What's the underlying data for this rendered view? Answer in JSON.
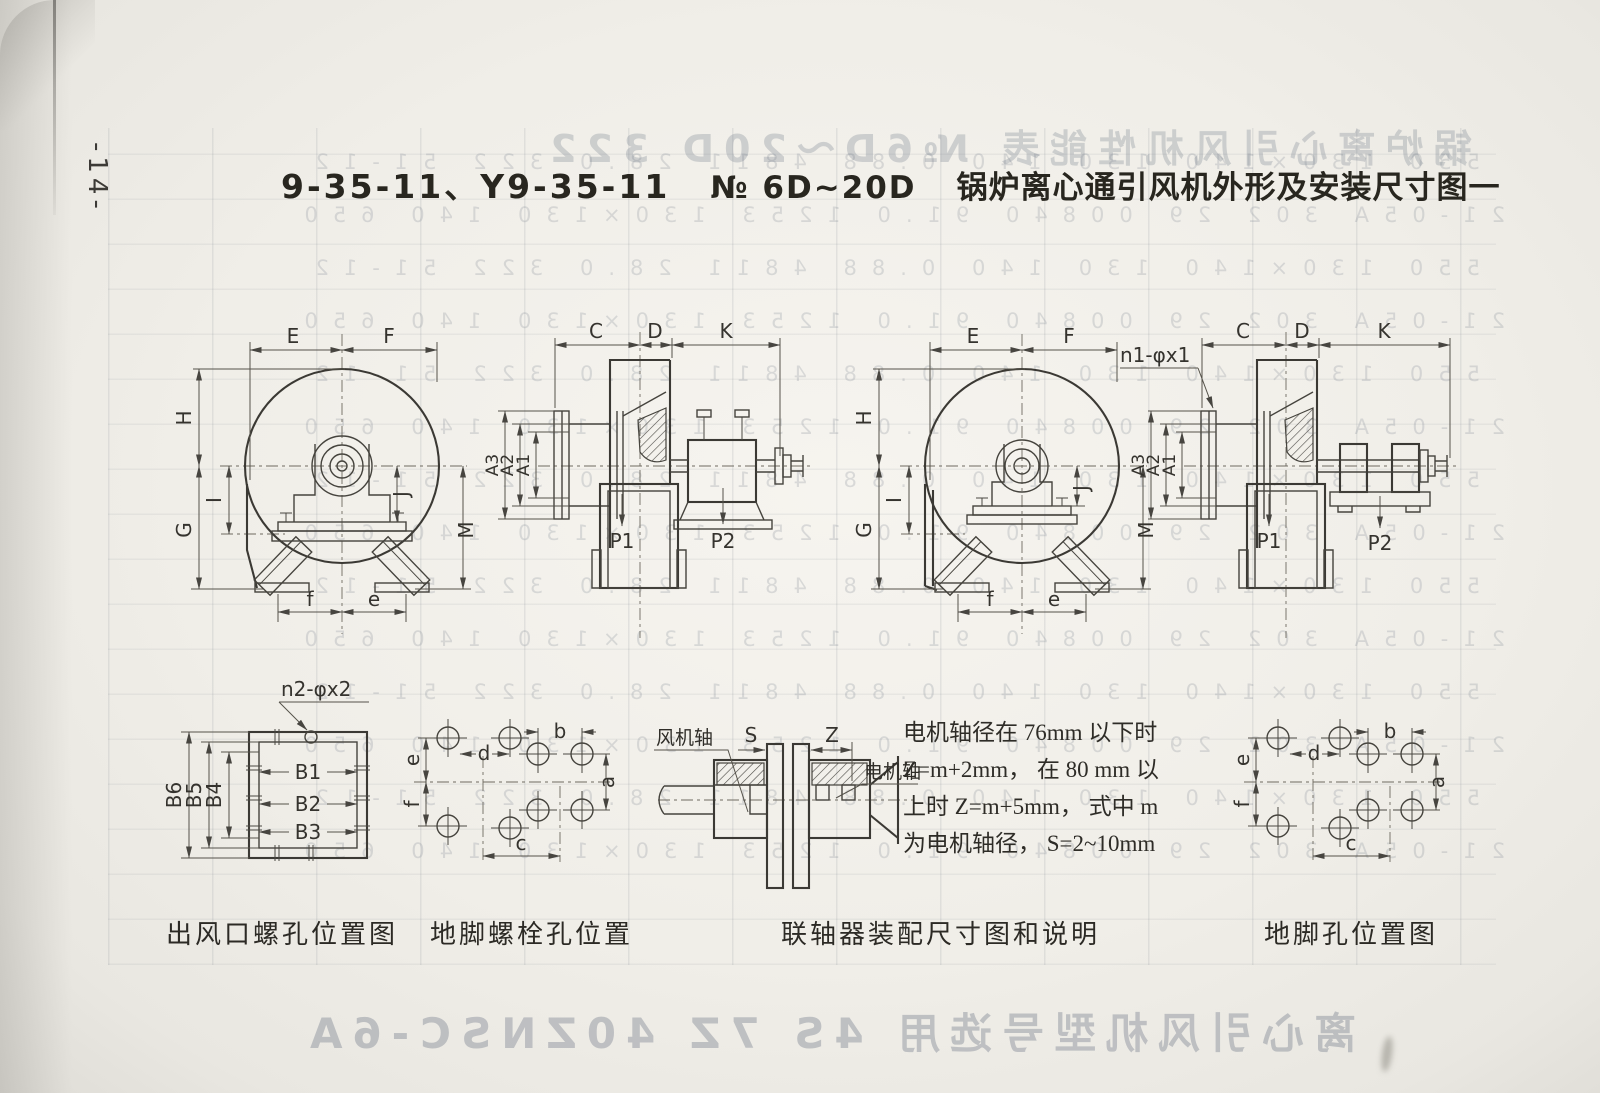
{
  "page": {
    "number": "-14-",
    "title": {
      "models": "9-35-11、Y9-35-11",
      "size_range": "№ 6D~20D",
      "name": "锅炉离心通引风机外形及安装尺寸图一"
    }
  },
  "labels": {
    "front": {
      "E": "E",
      "F": "F",
      "H": "H",
      "I": "I",
      "G": "G",
      "J": "J",
      "M": "M",
      "f": "f",
      "e": "e"
    },
    "side": {
      "C": "C",
      "D": "D",
      "K": "K",
      "A1": "A1",
      "A2": "A2",
      "A3": "A3",
      "P1": "P1",
      "P2": "P2",
      "n1": "n1-φx1"
    },
    "flange": {
      "note": "n2-φx2",
      "B1": "B1",
      "B2": "B2",
      "B3": "B3",
      "B4": "B4",
      "B5": "B5",
      "B6": "B6"
    },
    "foundation": {
      "a": "a",
      "b": "b",
      "c": "c",
      "d": "d",
      "e": "e",
      "f": "f"
    },
    "coupling": {
      "S": "S",
      "Z": "Z",
      "fan_shaft": "风机轴",
      "motor_shaft": "电机轴"
    }
  },
  "note": {
    "lines": [
      "电机轴径在 76mm 以下时",
      "Z=m+2mm， 在 80 mm 以",
      "上时 Z=m+5mm， 式中 m",
      "为电机轴径， S=2~10mm"
    ]
  },
  "captions": {
    "outlet_flange": "出风口螺孔位置图",
    "foundation_bolts": "地脚螺栓孔位置",
    "coupling": "联轴器装配尺寸图和说明",
    "foundation_holes": "地脚孔位置图"
  },
  "ghost": {
    "row_a": "550  130×140  130  140  0.88  4811  28.0  322  51-12",
    "row_b": "21-05A  302  29  00840  91.0  1253  130×130  140  650",
    "headline_top": "锅炉离心引风机性能表 №6D～20D 322",
    "headline_bottom": "离心引风机型号选用 4S 7Z 40ZNSC-6A"
  }
}
